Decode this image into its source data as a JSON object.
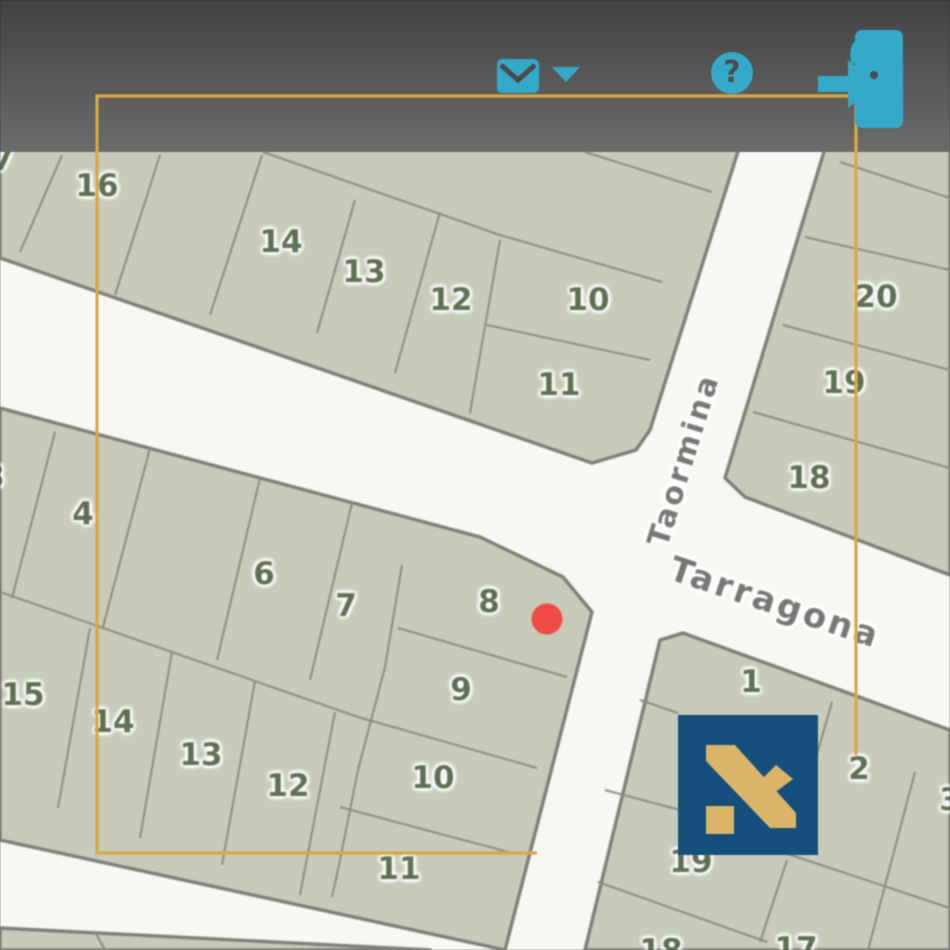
{
  "toolbar": {
    "gradient_top": "#424242",
    "gradient_bottom": "#6c6c6c",
    "icon_color": "#35a9ca",
    "icon_detail_color": "#4b4b4b",
    "items": [
      {
        "name": "messages",
        "icon": "envelope-icon",
        "has_dropdown": true
      },
      {
        "name": "help",
        "icon": "question-icon",
        "glyph": "?"
      },
      {
        "name": "logout",
        "icon": "exit-door-icon"
      }
    ]
  },
  "map": {
    "colors": {
      "road": "#f7f7f3",
      "parcel_fill": "#c8caba",
      "parcel_line": "#8a8c84",
      "block_edge": "#7d7f79",
      "number": "#5e7052",
      "street": "#777874"
    },
    "streets": [
      {
        "label": "Taormina",
        "x": 684,
        "y": 460,
        "rotation": -73,
        "size": 30
      },
      {
        "label": "Tarragona",
        "x": 775,
        "y": 603,
        "rotation": 18.5,
        "size": 34
      }
    ],
    "parcel_labels": [
      {
        "text": "7",
        "x": 3,
        "y": 160
      },
      {
        "text": "16",
        "x": 97,
        "y": 186
      },
      {
        "text": "14",
        "x": 281,
        "y": 242
      },
      {
        "text": "13",
        "x": 364,
        "y": 272
      },
      {
        "text": "12",
        "x": 451,
        "y": 300
      },
      {
        "text": "10",
        "x": 588,
        "y": 300
      },
      {
        "text": "11",
        "x": 559,
        "y": 385
      },
      {
        "text": "20",
        "x": 876,
        "y": 297
      },
      {
        "text": "19",
        "x": 844,
        "y": 383
      },
      {
        "text": "18",
        "x": 809,
        "y": 478
      },
      {
        "text": "3",
        "x": -6,
        "y": 477
      },
      {
        "text": "4",
        "x": 83,
        "y": 514
      },
      {
        "text": "6",
        "x": 264,
        "y": 574
      },
      {
        "text": "7",
        "x": 346,
        "y": 606
      },
      {
        "text": "8",
        "x": 489,
        "y": 602
      },
      {
        "text": "9",
        "x": 461,
        "y": 690
      },
      {
        "text": "10",
        "x": 433,
        "y": 778
      },
      {
        "text": "11",
        "x": 399,
        "y": 869
      },
      {
        "text": "15",
        "x": 23,
        "y": 695
      },
      {
        "text": "14",
        "x": 113,
        "y": 722
      },
      {
        "text": "13",
        "x": 201,
        "y": 755
      },
      {
        "text": "12",
        "x": 288,
        "y": 786
      },
      {
        "text": "1",
        "x": 751,
        "y": 682
      },
      {
        "text": "2",
        "x": 859,
        "y": 769
      },
      {
        "text": "3",
        "x": 950,
        "y": 800
      },
      {
        "text": "19",
        "x": 691,
        "y": 862
      },
      {
        "text": "18",
        "x": 661,
        "y": 951
      },
      {
        "text": "17",
        "x": 796,
        "y": 949
      }
    ],
    "marker": {
      "x": 547,
      "y": 619,
      "diameter": 31,
      "color": "#f04a45"
    }
  },
  "selection": {
    "color": "#d9a843",
    "points": [
      [
        537,
        853
      ],
      [
        97,
        853
      ],
      [
        97,
        96
      ],
      [
        856,
        96
      ],
      [
        856,
        755
      ]
    ]
  },
  "logo": {
    "background": "#15507d",
    "mark_color": "#d9b469"
  }
}
